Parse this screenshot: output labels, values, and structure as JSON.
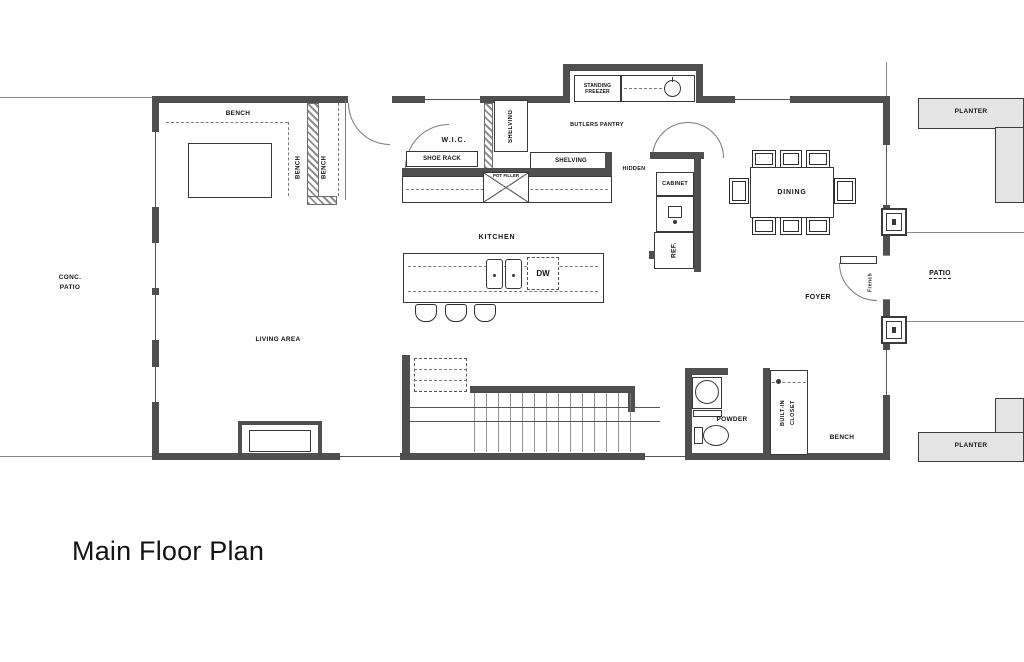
{
  "title": "Main Floor Plan",
  "colors": {
    "wall": "#4f4f4f",
    "planter-fill": "#e4e4e4",
    "ink": "#151515"
  },
  "labels": {
    "bench_top": "BENCH",
    "bench_left_a": "BENCH",
    "bench_left_b": "BENCH",
    "wic": "W.I.C.",
    "shoe_rack": "SHOE RACK",
    "shelving_vert": "SHELVING",
    "shelving_horiz": "SHELVING",
    "pot_filler": "POT FILLER",
    "standing_freezer_line1": "STANDING",
    "standing_freezer_line2": "FREEZER",
    "butlers_pantry": "BUTLERS PANTRY",
    "hidden": "HIDDEN",
    "cabinet": "CABINET",
    "ref": "REF.",
    "dining": "DINING",
    "kitchen": "KITCHEN",
    "dw": "DW",
    "conc_patio_line1": "CONC.",
    "conc_patio_line2": "PATIO",
    "living_area": "LIVING AREA",
    "foyer": "FOYER",
    "french": "French",
    "patio": "PATIO",
    "planter_top": "PLANTER",
    "planter_bottom": "PLANTER",
    "powder": "POWDER",
    "built_in_line1": "BUILT-IN",
    "built_in_line2": "CLOSET",
    "bench_bottom": "BENCH"
  }
}
